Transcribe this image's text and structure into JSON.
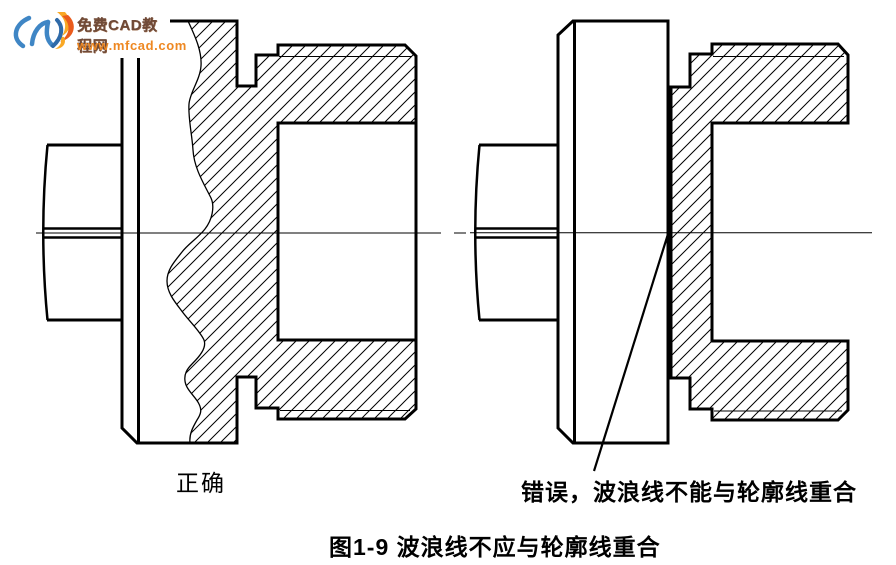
{
  "page": {
    "background_color": "#ffffff",
    "ink_color": "#000000"
  },
  "watermark": {
    "site_name": "免费CAD教程网",
    "site_url": "www.mfcad.com",
    "name_color": "#6f4a38",
    "url_color": "#ee8822",
    "logo_blue": "#3f86c5",
    "logo_dark_blue": "#2f6aa8",
    "logo_orange": "#f9a825",
    "logo_red_orange": "#ea5b1c"
  },
  "figure": {
    "left_label": "正确",
    "right_label": "错误，波浪线不能与轮廓线重合",
    "caption": "图1-9 波浪线不应与轮廓线重合",
    "left_view_meaning": "correct partial-section with wavy break line",
    "right_view_meaning": "incorrect - wavy line coincides with contour line"
  }
}
